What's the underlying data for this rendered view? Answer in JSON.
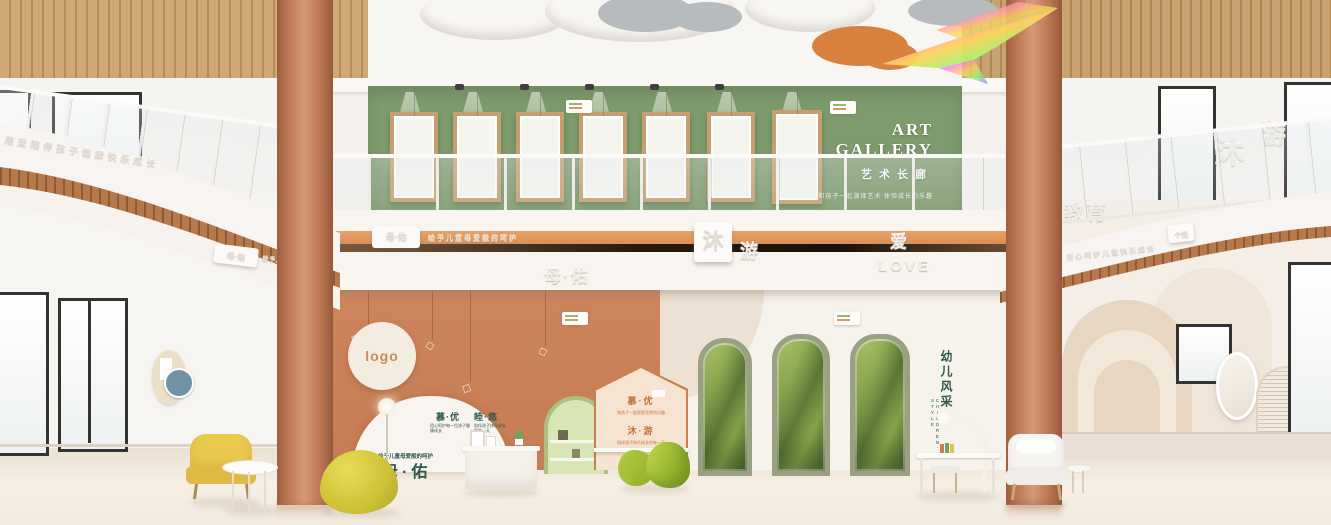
{
  "palette": {
    "accent_orange": "#dd9a62",
    "column_terracotta": "#c17b57",
    "gallery_green": "#7e9b6d",
    "brand_green": "#2f574c",
    "brand_orange": "#c8703d",
    "floor_cream": "#efe5d7"
  },
  "gallery": {
    "title": "ART GALLERY",
    "subtitle": "艺术长廊",
    "tagline": "和孩子一起演绎艺术 体验成长的乐趣"
  },
  "fascia": {
    "left_embossed": "用爱陪伴孩子健康快乐成长",
    "left_badge": "母·佑",
    "left_badge_tag": "给予儿童母爱般的呵护",
    "center_badge": "母·佑",
    "center_badge_tag": "给予儿童母爱般的呵护",
    "mu_tile": "沐",
    "you_char": "游",
    "brand_center": "母·佑",
    "ai_char": "爱",
    "love_text": "LOVE",
    "right_partial": "教育",
    "right_embossed": "用心呵护儿童快乐成长",
    "right_badge": "个性"
  },
  "upper_right": {
    "mu": "沐",
    "you": "游"
  },
  "logo_circle": {
    "label": "logo"
  },
  "ornament": {
    "glyph": "◇"
  },
  "arch_display": {
    "brand_left": "慕·优",
    "brand_right": "睦·悠",
    "sub_left": "用心呵护每一位孩子健康成长",
    "sub_right": "陪伴孩子快乐成长的每一天",
    "tagline": "给予儿童母爱般的呵护",
    "brand_large": "母·佑"
  },
  "house_panel": {
    "row1": "慕·优",
    "row1_sub": "和孩子一起探索世界的乐趣",
    "row2": "沐·游",
    "row2_sub": "陪伴孩子快乐成长的每一天"
  },
  "kids_wall": {
    "title": "幼儿风采",
    "sub": "CHILDREN'S STYLE"
  }
}
